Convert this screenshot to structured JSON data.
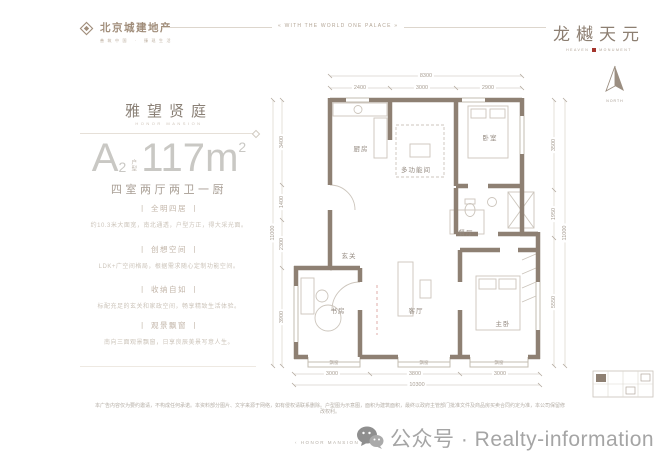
{
  "header": {
    "logo": {
      "name": "北京城建地产",
      "tagline": "善筑中国 · 臻现生活"
    },
    "banner": "« WITH THE WORLD ONE PALACE »",
    "brand": {
      "name": "龙樾天元",
      "sub_left": "HEAVEN",
      "sub_right": "MONUMENT"
    }
  },
  "panel": {
    "title": "雅望贤庭",
    "subtitle": "HONOR MANSION",
    "unit": {
      "letter": "A",
      "index": "2",
      "type": "户型",
      "area": "117",
      "unit": "m",
      "sup": "2"
    },
    "layout": "四室两厅两卫一厨",
    "features": [
      {
        "title": "丨 全明四居 丨",
        "desc": "约10.3米大面宽，南北通透，户型方正，得大采光面。"
      },
      {
        "title": "丨 创想空间 丨",
        "desc": "LDK+广空间格局，根据需求随心定制功能空间。"
      },
      {
        "title": "丨 收纳自如 丨",
        "desc": "标配充足的玄关和家政空间，畅享精致生活体验。"
      },
      {
        "title": "丨 观景飘窗 丨",
        "desc": "南向三面观景飘窗，日享良辰美景写意人生。"
      }
    ]
  },
  "plan": {
    "north_label": "NORTH",
    "rooms": [
      {
        "label": "厨房"
      },
      {
        "label": "多功能间"
      },
      {
        "label": "卧室"
      },
      {
        "label": "餐厅"
      },
      {
        "label": "玄关"
      },
      {
        "label": "书房"
      },
      {
        "label": "客厅"
      },
      {
        "label": "主卧"
      }
    ],
    "bays": [
      "飘窗",
      "飘窗",
      "飘窗"
    ],
    "dims": {
      "top": [
        "2400",
        "3000",
        "2900"
      ],
      "top_total": "8300",
      "bottom": [
        "3000",
        "3800",
        "3000"
      ],
      "bottom_total": "10300",
      "left": [
        "3400",
        "1400",
        "2300",
        "3900"
      ],
      "left_total": "11000",
      "right": [
        "3500",
        "1950",
        "5550"
      ],
      "right_total": "11000"
    }
  },
  "footer": {
    "disclaimer": "本广告内容仅为要约邀请，不构成任何承诺。本资料部分图片、文字来源于网络，如有侵权请联系删除。户型图为示意图，面积为建筑面积，最终以政府主管部门批准文件及商品房买卖合同约定为准，本公司保留修改权利。",
    "mark": "‹ HONOR MANSION ›",
    "watermark": "公众号 · Realty-information"
  },
  "colors": {
    "wall": "#8e8073",
    "accent_red": "#a3342c",
    "dim_text": "#a89e93"
  }
}
